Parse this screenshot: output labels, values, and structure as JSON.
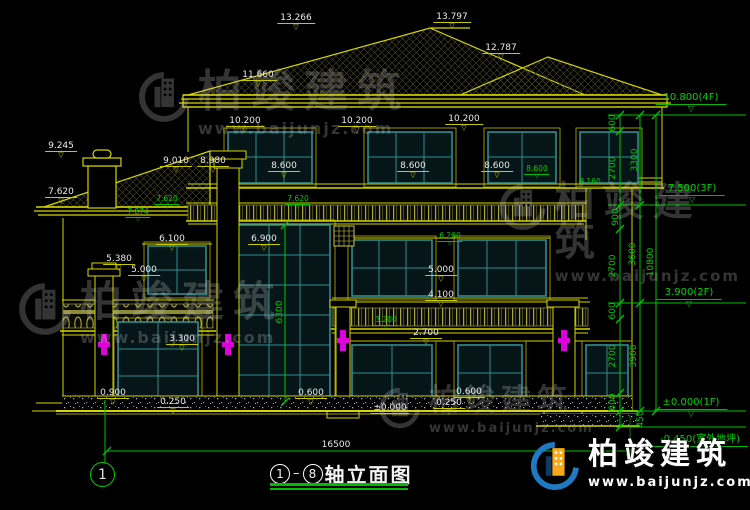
{
  "drawing_title": {
    "axis_from": "1",
    "axis_to": "8",
    "text": "轴立面图"
  },
  "axis_bubble": "1",
  "watermark": {
    "name": "柏竣建筑",
    "url": "www.baijunjz.com"
  },
  "colors": {
    "line_yellow": "#d6d600",
    "dim_green": "#00c200",
    "text_white": "#e9e9e9",
    "window_teal": "#2f8f8f",
    "ornament_magenta": "#dd00dd",
    "logo_blue": "#1f7ac4",
    "logo_orange": "#f7a81b"
  },
  "annotations": {
    "levels": [
      {
        "text": "13.266",
        "cx": 296,
        "cy": 13
      },
      {
        "text": "13.797",
        "cx": 452,
        "cy": 12
      },
      {
        "text": "12.787",
        "cx": 501,
        "cy": 43
      },
      {
        "text": "11.660",
        "cx": 258,
        "cy": 70
      },
      {
        "text": "10.200",
        "cx": 245,
        "cy": 116
      },
      {
        "text": "10.200",
        "cx": 357,
        "cy": 116
      },
      {
        "text": "10.200",
        "cx": 464,
        "cy": 114
      },
      {
        "text": "9.245",
        "cx": 61,
        "cy": 141
      },
      {
        "text": "9.010",
        "cx": 176,
        "cy": 156
      },
      {
        "text": "8.980",
        "cx": 213,
        "cy": 156
      },
      {
        "text": "8.600",
        "cx": 284,
        "cy": 161
      },
      {
        "text": "8.600",
        "cx": 413,
        "cy": 161
      },
      {
        "text": "8.600",
        "cx": 497,
        "cy": 161
      },
      {
        "text": "7.620",
        "cx": 61,
        "cy": 187
      },
      {
        "text": "6.100",
        "cx": 172,
        "cy": 234
      },
      {
        "text": "6.900",
        "cx": 264,
        "cy": 234
      },
      {
        "text": "5.380",
        "cx": 119,
        "cy": 254
      },
      {
        "text": "5.000",
        "cx": 144,
        "cy": 265
      },
      {
        "text": "5.000",
        "cx": 441,
        "cy": 265
      },
      {
        "text": "4.100",
        "cx": 441,
        "cy": 290
      },
      {
        "text": "3.300",
        "cx": 182,
        "cy": 334
      },
      {
        "text": "2.700",
        "cx": 426,
        "cy": 328
      },
      {
        "text": "0.900",
        "cx": 113,
        "cy": 388
      },
      {
        "text": "0.250",
        "cx": 173,
        "cy": 397
      },
      {
        "text": "0.600",
        "cx": 311,
        "cy": 388
      },
      {
        "text": "0.250",
        "cx": 449,
        "cy": 398
      },
      {
        "text": "0.600",
        "cx": 469,
        "cy": 387
      },
      {
        "text": "±0.000",
        "cx": 390,
        "cy": 403,
        "style": "line"
      },
      {
        "text": "16500",
        "cx": 336,
        "cy": 440,
        "style": "bare"
      }
    ],
    "greens": [
      {
        "text": "7.620",
        "cx": 167,
        "cy": 195
      },
      {
        "text": "7.874",
        "cx": 138,
        "cy": 208
      },
      {
        "text": "7.620",
        "cx": 298,
        "cy": 195
      },
      {
        "text": "8.600",
        "cx": 537,
        "cy": 165
      },
      {
        "text": "8.160",
        "cx": 590,
        "cy": 178
      },
      {
        "text": "6.260",
        "cx": 450,
        "cy": 232
      },
      {
        "text": "3.200",
        "cx": 386,
        "cy": 316
      }
    ],
    "flags": [
      {
        "text": "10.800(4F)",
        "cx": 691,
        "cy": 92
      },
      {
        "text": "7.500(3F)",
        "cx": 692,
        "cy": 183
      },
      {
        "text": "3.900(2F)",
        "cx": 689,
        "cy": 287
      },
      {
        "text": "±0.000(1F)",
        "cx": 691,
        "cy": 397
      },
      {
        "text": "-0.450(室外地坪)",
        "cx": 700,
        "cy": 434
      }
    ],
    "rotated": [
      {
        "text": "600",
        "cx": 613,
        "cy": 123
      },
      {
        "text": "2700",
        "cx": 613,
        "cy": 168
      },
      {
        "text": "900",
        "cx": 616,
        "cy": 217
      },
      {
        "text": "2700",
        "cx": 613,
        "cy": 266
      },
      {
        "text": "600",
        "cx": 613,
        "cy": 311
      },
      {
        "text": "2700",
        "cx": 613,
        "cy": 356
      },
      {
        "text": "600",
        "cx": 613,
        "cy": 402
      },
      {
        "text": "450",
        "cx": 641,
        "cy": 419
      },
      {
        "text": "3300",
        "cx": 635,
        "cy": 160
      },
      {
        "text": "3600",
        "cx": 633,
        "cy": 254
      },
      {
        "text": "3900",
        "cx": 634,
        "cy": 356
      },
      {
        "text": "10800",
        "cx": 651,
        "cy": 262
      },
      {
        "text": "6300",
        "cx": 280,
        "cy": 312
      }
    ]
  }
}
